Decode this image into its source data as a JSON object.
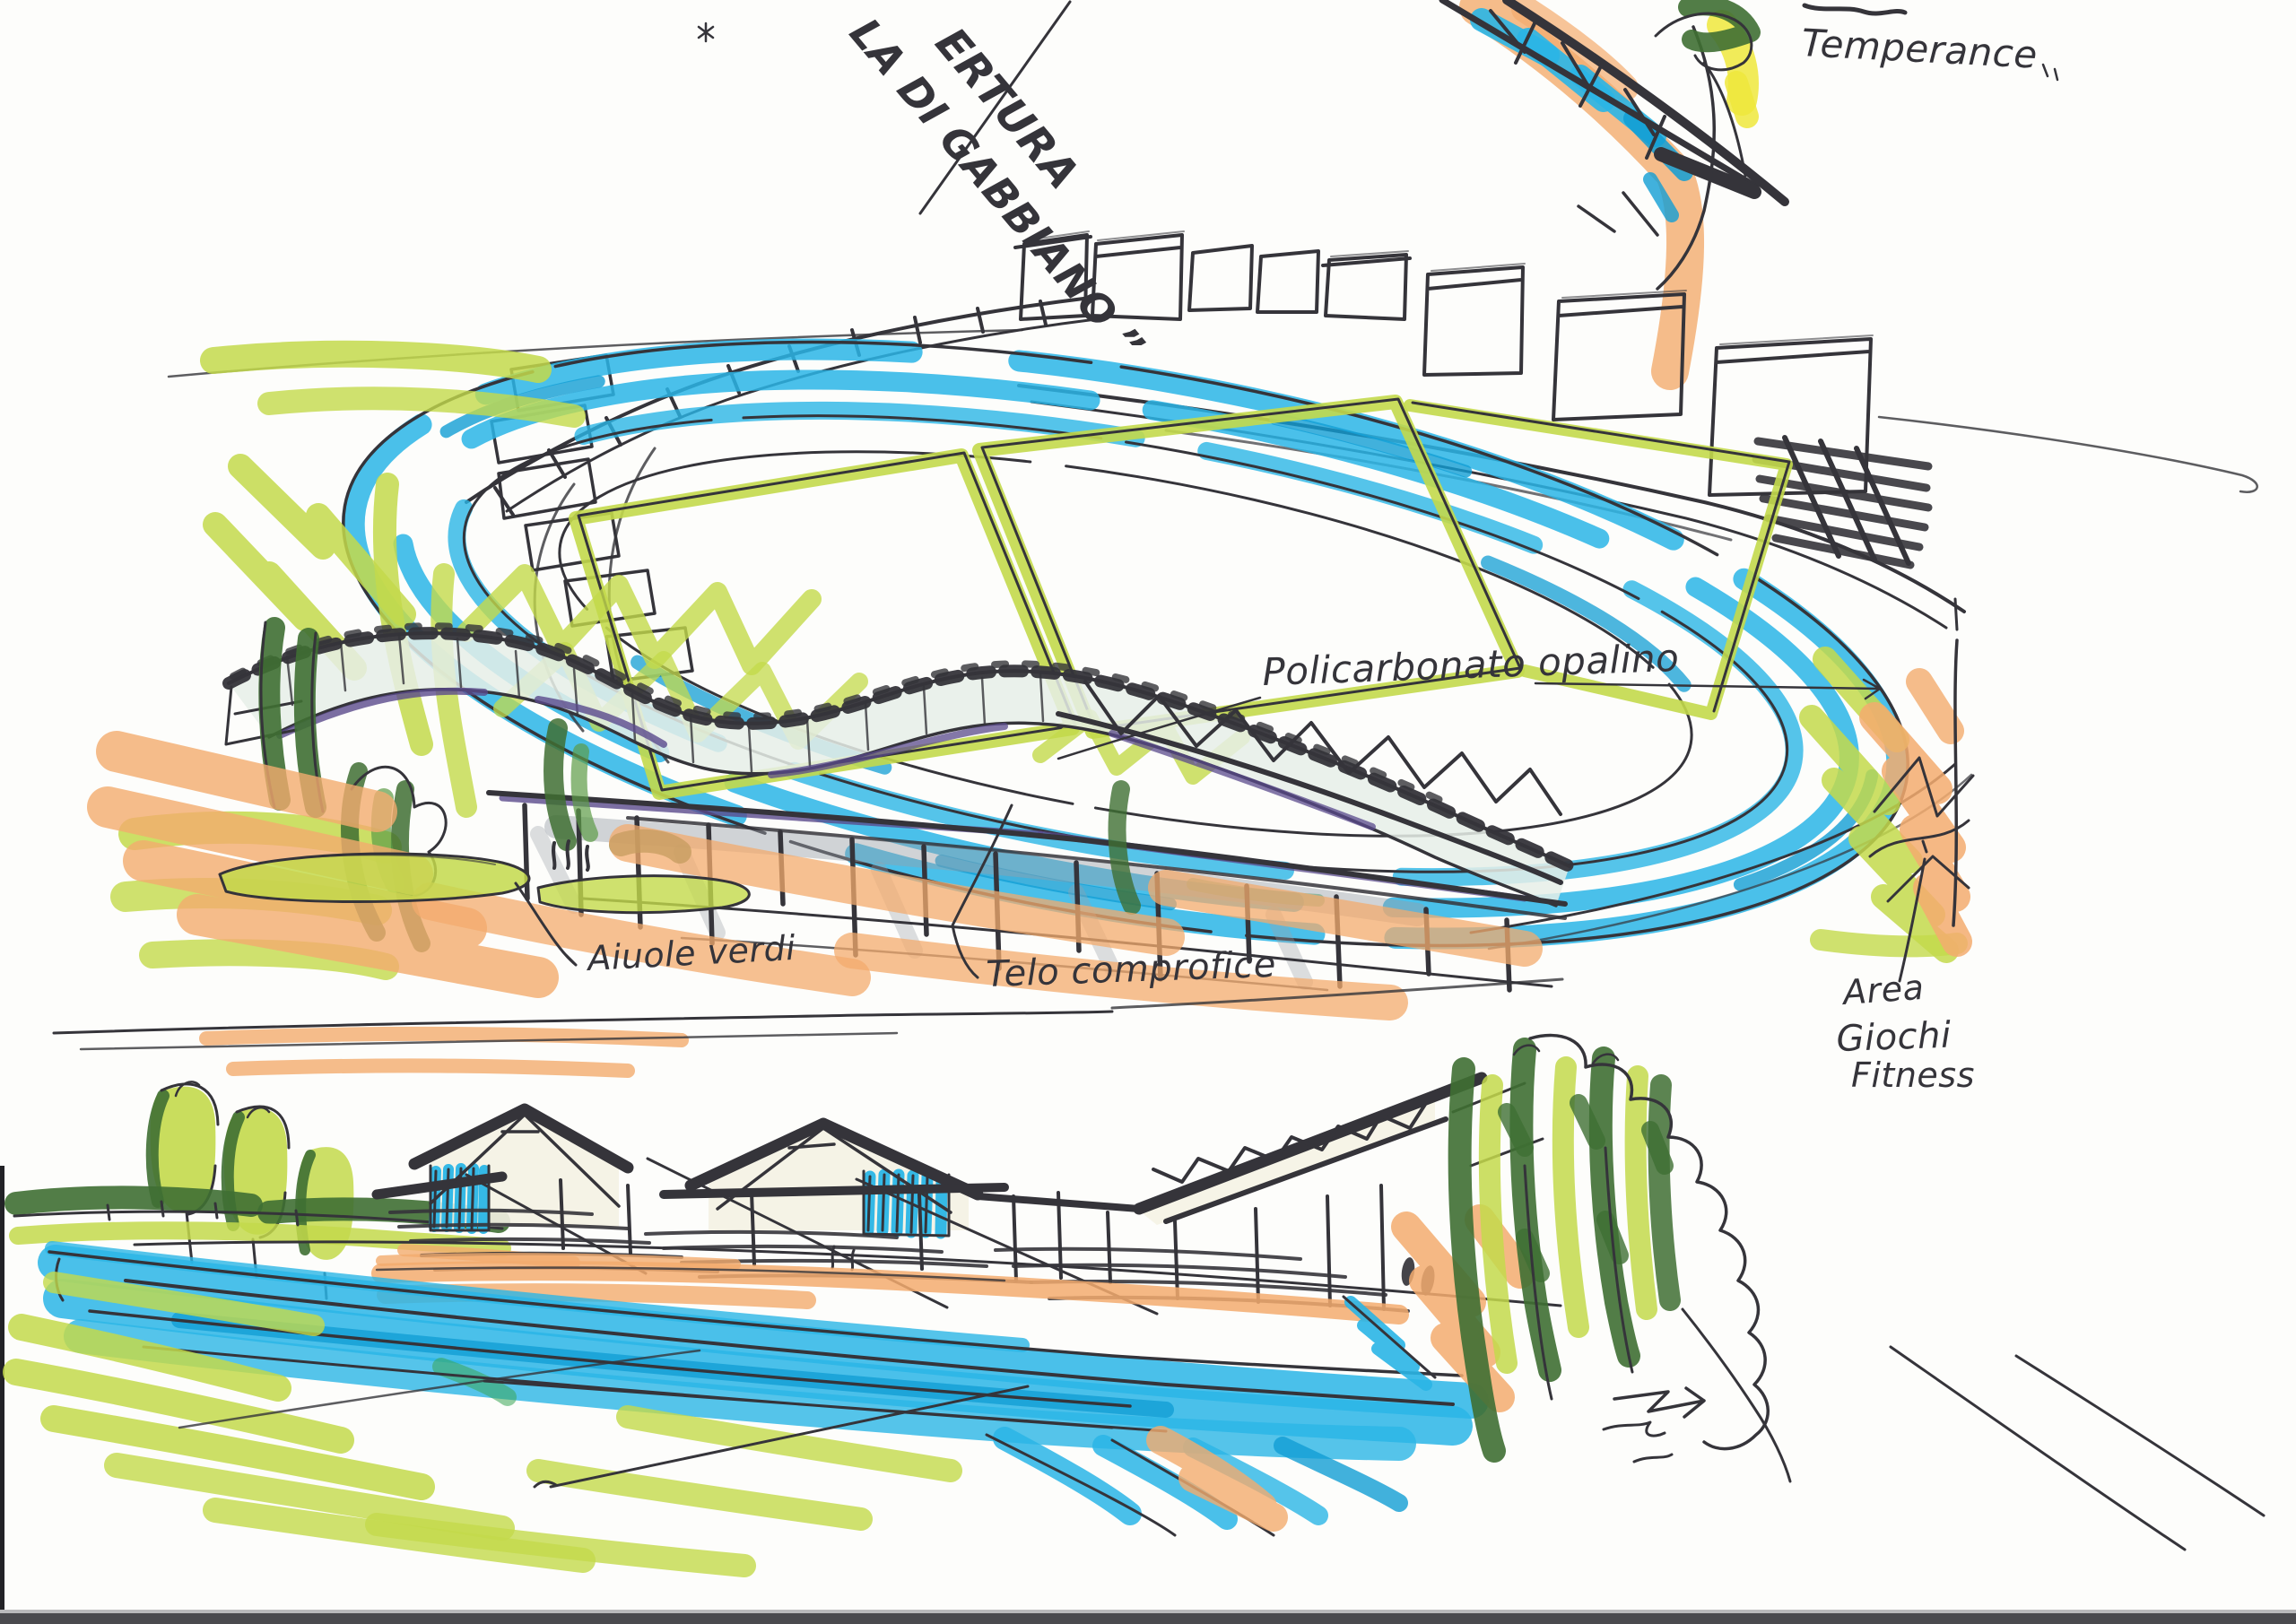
{
  "annotations": {
    "cover_note": {
      "line1": "ERTURA",
      "line2": "LA DI GABBIANO ”"
    },
    "temperance": {
      "text": "Temperance"
    },
    "polycarbonate": {
      "text": "Policarbonato opalino"
    },
    "green_beds": {
      "text": "Aiuole verdi"
    },
    "cover_sheet": {
      "text": "Telo comprofice"
    },
    "fitness_area": {
      "line1": "Area",
      "line2": "Giochi",
      "line3": "Fitness"
    }
  },
  "palette": {
    "paper": "#fdfdfb",
    "ink": "#35343a",
    "cyan": "#2ab5e6",
    "cyan_deep": "#119dd4",
    "lime": "#c3d94b",
    "lime_soft": "#d9e683",
    "yellow": "#efe73c",
    "orange": "#f3ab6e",
    "green_dark": "#3f6f33",
    "green_mid": "#5d9b47",
    "green_accent": "#3aa655",
    "purple": "#5a4a8c",
    "glass": "#e6eee7",
    "cream": "#f4f2e3",
    "gray": "#9aa0a8",
    "scan_edge": "#4a4a4e"
  }
}
